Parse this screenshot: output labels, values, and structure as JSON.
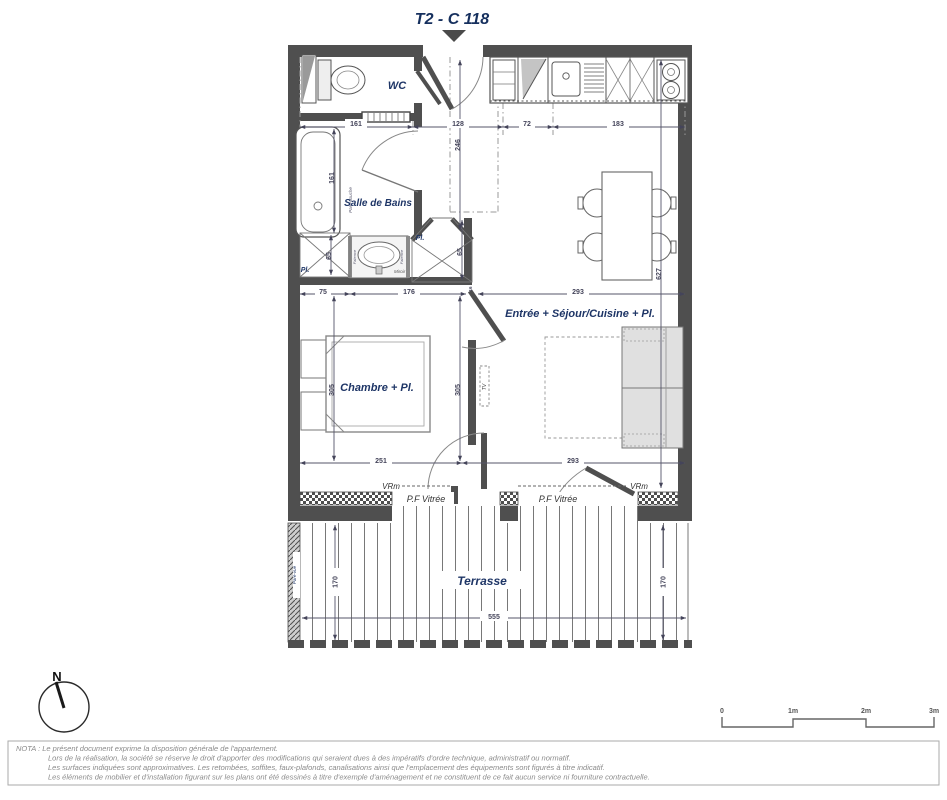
{
  "title": "T2 - C 118",
  "rooms": {
    "wc": "WC",
    "bathroom": "Salle de Bains",
    "bedroom": "Chambre + Pl.",
    "living": "Entrée + Séjour/Cuisine + Pl.",
    "terrace": "Terrasse",
    "closet_left": "Pl.",
    "closet_right": "Pl."
  },
  "annotations": {
    "shutter_left": "VRm",
    "shutter_right": "VRm",
    "glazed_door_left": "P.F Vitrée",
    "glazed_door_right": "P.F Vitrée",
    "mirror": "Miroir",
    "tiling_left": "Faïence",
    "tiling_right": "Faïence",
    "shower_screen": "Pare-douche",
    "privacy_screen": "Pare-vue",
    "tv": "TV",
    "north": "N"
  },
  "dimensions": {
    "top": [
      "161",
      "128",
      "72",
      "183"
    ],
    "entry_depth": "246",
    "bath_height": "161",
    "closet_left_h": "65",
    "closet_right_h": "65",
    "mid": [
      "75",
      "176",
      "16",
      "293"
    ],
    "bedroom_h_left": "305",
    "bedroom_h_right": "305",
    "living_h": "627",
    "bottom": [
      "251",
      "293"
    ],
    "terrace_depth_left": "170",
    "terrace_depth_right": "170",
    "terrace_width": "555"
  },
  "scale_bar": {
    "labels": [
      "0",
      "1m",
      "2m",
      "3m"
    ]
  },
  "nota": {
    "line1": "NOTA : Le présent document exprime la disposition générale de l'appartement.",
    "line2": "Lors de la réalisation, la société se réserve le droit d'apporter des modifications qui seraient dues à des impératifs d'ordre technique, administratif ou normatif.",
    "line3": "Les surfaces indiquées sont approximatives. Les retombées, soffites, faux-plafonds, canalisations ainsi que l'emplacement des équipements sont figurés à titre indicatif.",
    "line4": "Les éléments de mobilier et d'installation figurant sur les plans ont été dessinés à titre d'exemple d'aménagement et ne constituent de ce fait aucun service ni fourniture contractuelle."
  },
  "colors": {
    "wall": "#4f4f4f",
    "label_blue": "#1e3566",
    "dim": "#44445a",
    "nota": "#8a8a8a"
  }
}
